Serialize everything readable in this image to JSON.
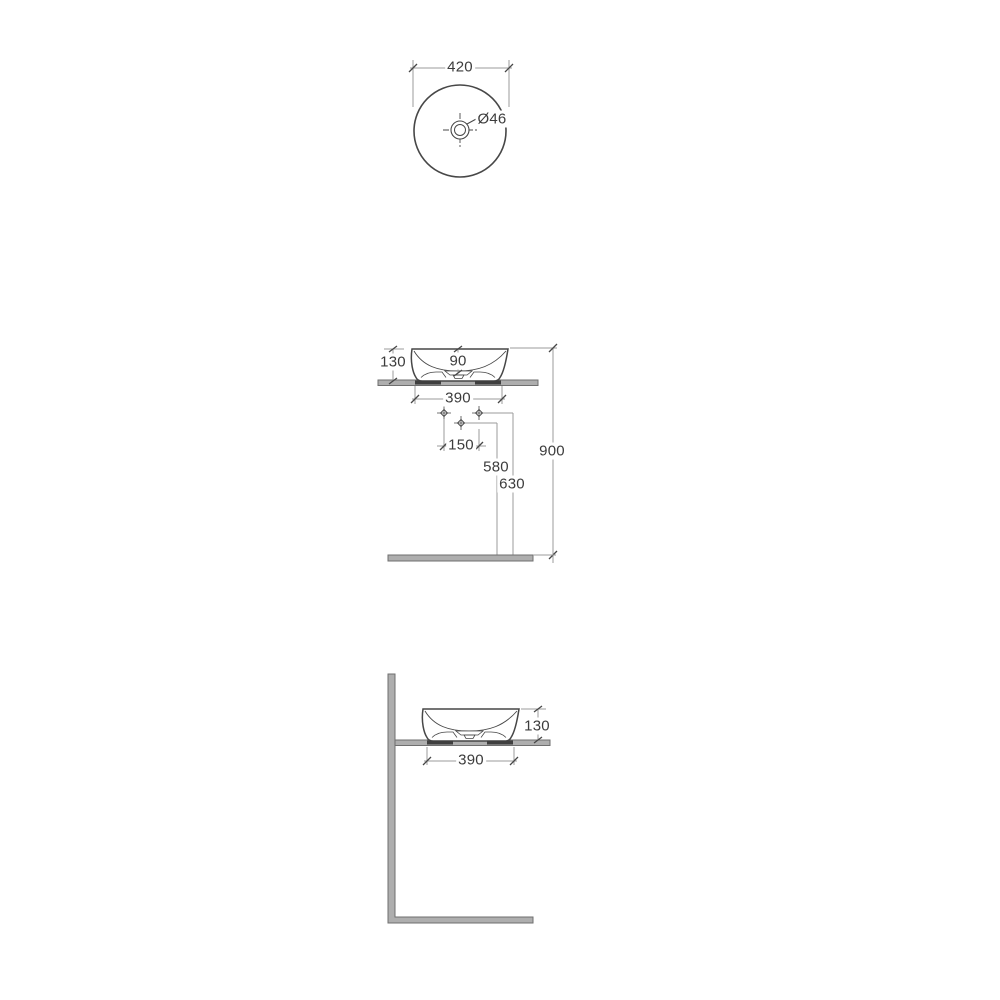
{
  "drawing": {
    "type": "technical-dimension-drawing",
    "subject": "round countertop washbasin",
    "views": {
      "top": {
        "name": "top view",
        "width_dim": "420",
        "drain_dim": "Ø46"
      },
      "front": {
        "name": "front view",
        "height_dim": "130",
        "bowl_depth_dim": "90",
        "width_dim": "390",
        "tap_spacing_dim": "150",
        "mid_tap_height_dim": "580",
        "tap_height_dim": "630",
        "total_height_dim": "900"
      },
      "side": {
        "name": "side view",
        "height_dim": "130",
        "width_dim": "390"
      }
    },
    "colors": {
      "background": "#ffffff",
      "outline": "#474747",
      "dim_line": "#9b9b9b",
      "tick": "#474747",
      "text": "#3c3c3c",
      "surface_fill": "#aeaeae",
      "surface_stroke": "#6f6f6f",
      "contact_pad": "#3f3f3f"
    }
  }
}
